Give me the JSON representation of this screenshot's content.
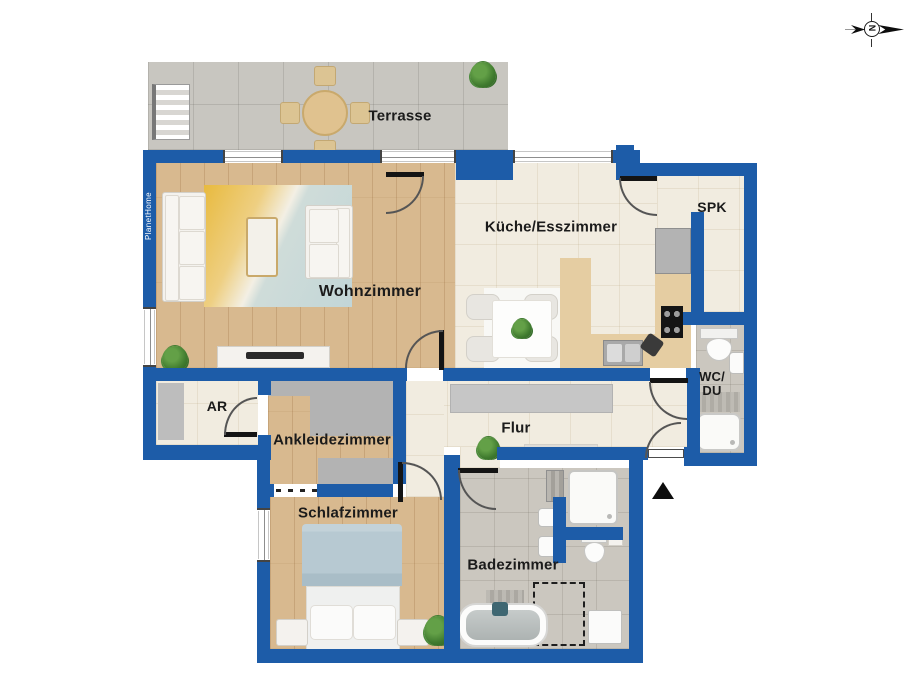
{
  "brand": {
    "watermark": "PlanetHome"
  },
  "compass": {
    "north_letter": "N"
  },
  "rooms": {
    "terrasse": {
      "label": "Terrasse"
    },
    "wohnzimmer": {
      "label": "Wohnzimmer"
    },
    "kueche_esszimmer": {
      "label": "Küche/Esszimmer"
    },
    "spk": {
      "label": "SPK"
    },
    "wc_du": {
      "label_line1": "WC/",
      "label_line2": "DU"
    },
    "ar": {
      "label": "AR"
    },
    "ankleidezimmer": {
      "label": "Ankleidezimmer"
    },
    "flur": {
      "label": "Flur"
    },
    "schlafzimmer": {
      "label": "Schlafzimmer"
    },
    "badezimmer": {
      "label": "Badezimmer"
    }
  },
  "colors": {
    "wall": "#1d5ca8",
    "terrace_floor": "#c8c6c0",
    "tile_floor": "#f1ece0",
    "wood_floor": "#d8b98f",
    "bath_floor": "#cbc7bf",
    "rug_yellow": "#e8ba3e",
    "rug_blue": "#c2d6d8",
    "bed_blanket": "#b7c9d2",
    "furniture_white": "#f4f2ee",
    "cabinet_gray": "#b3b3b3",
    "counter_wood": "#e5cda2",
    "label_text": "#1b1b1b"
  }
}
